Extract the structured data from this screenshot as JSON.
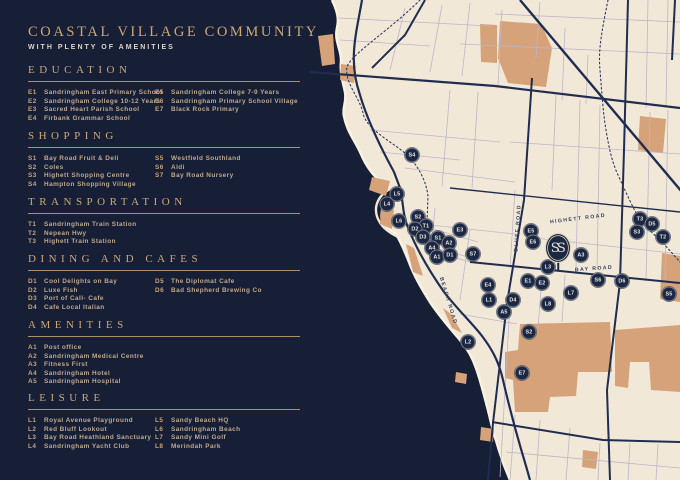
{
  "header": {
    "title": "COASTAL VILLAGE COMMUNITY",
    "subtitle": "WITH PLENTY OF AMENITIES"
  },
  "sections": [
    {
      "name": "EDUCATION",
      "top": 64,
      "columns": [
        [
          {
            "code": "E1",
            "label": "Sandringham East Primary School"
          },
          {
            "code": "E2",
            "label": "Sandringham College 10-12 Years"
          },
          {
            "code": "E3",
            "label": "Sacred Heart Parish School"
          },
          {
            "code": "E4",
            "label": "Firbank Grammar School"
          }
        ],
        [
          {
            "code": "E5",
            "label": "Sandringham College 7-9 Years"
          },
          {
            "code": "E6",
            "label": "Sandringham Primary School Village"
          },
          {
            "code": "E7",
            "label": "Black Rock Primary"
          }
        ]
      ]
    },
    {
      "name": "SHOPPING",
      "top": 130,
      "columns": [
        [
          {
            "code": "S1",
            "label": "Bay Road Fruit & Deli"
          },
          {
            "code": "S2",
            "label": "Coles"
          },
          {
            "code": "S3",
            "label": "Highett Shopping Centre"
          },
          {
            "code": "S4",
            "label": "Hampton Shopping Village"
          }
        ],
        [
          {
            "code": "S5",
            "label": "Westfield Southland"
          },
          {
            "code": "S6",
            "label": "Aldi"
          },
          {
            "code": "S7",
            "label": "Bay Road Nursery"
          }
        ]
      ]
    },
    {
      "name": "TRANSPORTATION",
      "top": 196,
      "columns": [
        [
          {
            "code": "T1",
            "label": "Sandringham Train Station"
          },
          {
            "code": "T2",
            "label": "Nepean Hwy"
          },
          {
            "code": "T3",
            "label": "Highett Train Station"
          }
        ],
        []
      ]
    },
    {
      "name": "DINING AND CAFES",
      "top": 253,
      "columns": [
        [
          {
            "code": "D1",
            "label": "Cool Delights on Bay"
          },
          {
            "code": "D2",
            "label": "Luxe Fish"
          },
          {
            "code": "D3",
            "label": "Port of Call- Cafe"
          },
          {
            "code": "D4",
            "label": "Cafe Local Italian"
          }
        ],
        [
          {
            "code": "D5",
            "label": "The Diplomat Cafe"
          },
          {
            "code": "D6",
            "label": "Bad Shepherd Brewing Co"
          }
        ]
      ]
    },
    {
      "name": "AMENITIES",
      "top": 319,
      "columns": [
        [
          {
            "code": "A1",
            "label": "Post office"
          },
          {
            "code": "A2",
            "label": "Sandringham Medical Centre"
          },
          {
            "code": "A3",
            "label": "Fitness First"
          },
          {
            "code": "A4",
            "label": "Sandringham Hotel"
          },
          {
            "code": "A5",
            "label": "Sandringham Hospital"
          }
        ],
        []
      ]
    },
    {
      "name": "LEISURE",
      "top": 392,
      "columns": [
        [
          {
            "code": "L1",
            "label": "Royal Avenue Playground"
          },
          {
            "code": "L2",
            "label": "Red Bluff Lookout"
          },
          {
            "code": "L3",
            "label": "Bay Road Heathland Sanctuary"
          },
          {
            "code": "L4",
            "label": "Sandringham Yacht Club"
          }
        ],
        [
          {
            "code": "L5",
            "label": "Sandy Beach HQ"
          },
          {
            "code": "L6",
            "label": "Sandringham Beach"
          },
          {
            "code": "L7",
            "label": "Sandy Mini Golf"
          },
          {
            "code": "L8",
            "label": "Merindah Park"
          }
        ]
      ]
    }
  ],
  "map": {
    "site_marker": {
      "label": "SS",
      "x": 558,
      "y": 248
    },
    "road_labels": [
      {
        "text": "BEACH ROAD",
        "x": 448,
        "y": 301,
        "rotate": 73
      },
      {
        "text": "BLUFF ROAD",
        "x": 518,
        "y": 228,
        "rotate": -86
      },
      {
        "text": "HIGHETT ROAD",
        "x": 578,
        "y": 219,
        "rotate": -7
      },
      {
        "text": "BAY ROAD",
        "x": 594,
        "y": 269,
        "rotate": -4
      }
    ],
    "markers": [
      {
        "code": "S4",
        "x": 412,
        "y": 155
      },
      {
        "code": "L5",
        "x": 397,
        "y": 194
      },
      {
        "code": "L4",
        "x": 387,
        "y": 204
      },
      {
        "code": "L6",
        "x": 399,
        "y": 221
      },
      {
        "code": "S2",
        "x": 418,
        "y": 217
      },
      {
        "code": "T1",
        "x": 426,
        "y": 226
      },
      {
        "code": "D2",
        "x": 415,
        "y": 229
      },
      {
        "code": "D3",
        "x": 423,
        "y": 237
      },
      {
        "code": "S1",
        "x": 438,
        "y": 238
      },
      {
        "code": "E3",
        "x": 460,
        "y": 230
      },
      {
        "code": "A2",
        "x": 449,
        "y": 243
      },
      {
        "code": "A4",
        "x": 432,
        "y": 248
      },
      {
        "code": "A1",
        "x": 437,
        "y": 257
      },
      {
        "code": "D1",
        "x": 450,
        "y": 255
      },
      {
        "code": "S7",
        "x": 473,
        "y": 254
      },
      {
        "code": "E4",
        "x": 488,
        "y": 285
      },
      {
        "code": "L1",
        "x": 489,
        "y": 300
      },
      {
        "code": "D4",
        "x": 513,
        "y": 300
      },
      {
        "code": "A5",
        "x": 504,
        "y": 312
      },
      {
        "code": "L2",
        "x": 468,
        "y": 342
      },
      {
        "code": "S2",
        "x": 529,
        "y": 332
      },
      {
        "code": "E7",
        "x": 522,
        "y": 373
      },
      {
        "code": "E5",
        "x": 531,
        "y": 231
      },
      {
        "code": "E6",
        "x": 533,
        "y": 242
      },
      {
        "code": "L3",
        "x": 548,
        "y": 267
      },
      {
        "code": "E1",
        "x": 528,
        "y": 281
      },
      {
        "code": "E2",
        "x": 542,
        "y": 283
      },
      {
        "code": "L7",
        "x": 571,
        "y": 293
      },
      {
        "code": "L8",
        "x": 548,
        "y": 304
      },
      {
        "code": "A3",
        "x": 581,
        "y": 255
      },
      {
        "code": "S6",
        "x": 598,
        "y": 280
      },
      {
        "code": "D6",
        "x": 622,
        "y": 281
      },
      {
        "code": "T3",
        "x": 640,
        "y": 219
      },
      {
        "code": "D5",
        "x": 652,
        "y": 224
      },
      {
        "code": "S3",
        "x": 637,
        "y": 232
      },
      {
        "code": "T2",
        "x": 663,
        "y": 237
      },
      {
        "code": "S5",
        "x": 669,
        "y": 294
      }
    ],
    "colors": {
      "water_navy": "#161f36",
      "land_cream": "#f2e8d8",
      "patch_tan": "#d5a27a",
      "road_thick": "#202d50",
      "road_thin": "#bdb6c8",
      "accent_gold": "#cda676",
      "marker_navy": "#1b2845"
    }
  }
}
